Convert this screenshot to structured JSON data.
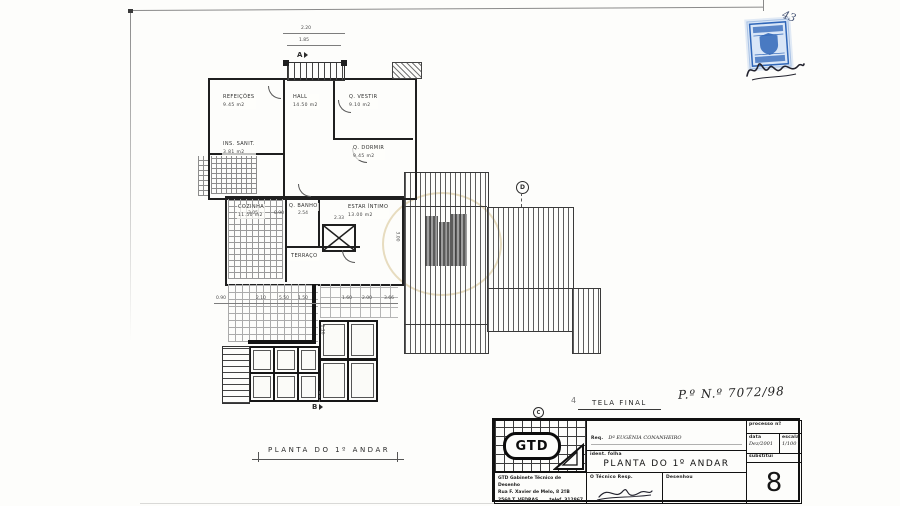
{
  "document": {
    "type": "scanned architectural drawing",
    "tela_final": "TELA FINAL",
    "process_number": "P.º N.º 7072/98",
    "fold_mark": "4",
    "caption": "PLANTA  DO  1º ANDAR",
    "stamp_note": "43"
  },
  "markers": {
    "a": "A",
    "b": "B",
    "c": "C",
    "d": "D"
  },
  "plan": {
    "rooms": [
      {
        "name": "REFEIÇÕES",
        "area": "9.45 m2"
      },
      {
        "name": "HALL",
        "area": "14.50 m2"
      },
      {
        "name": "Q. VESTIR",
        "area": "9.10 m2"
      },
      {
        "name": "Q. DORMIR",
        "area": "9.45 m2"
      },
      {
        "name": "INS. SANIT.",
        "area": "3.81 m2"
      },
      {
        "name": "COZINHA",
        "area": "11.50 m2"
      },
      {
        "name": "Q. BANHO",
        "area": ""
      },
      {
        "name": "ESTAR ÍNTIMO",
        "area": "13.00 m2"
      },
      {
        "name": "TERRAÇO",
        "area": ""
      }
    ],
    "dimensions": [
      "2.20",
      "1.85",
      "3.05",
      "0.90",
      "2.54",
      "2.33",
      "3.00",
      "0.90",
      "2.10",
      "5.50",
      "1.50",
      "1.60",
      "2.00",
      "3.66",
      "1.16"
    ]
  },
  "title_block": {
    "logo_text": "GTD",
    "req_label": "Req.",
    "req_value": "Dª EUGÉNIA CONANHEIRO",
    "local_label": "Local.",
    "local_value": "VILA FACAIA — RAMALHAL",
    "assunto_label": "Assunto.",
    "assunto_value": "LEGALIZAÇÃO DE ALTERAÇÕES",
    "ident_label": "ident. folha",
    "drawing_title": "PLANTA   DO   1º ANDAR",
    "processo_label": "processo nº",
    "data_label": "data",
    "data_value": "Dez/2001",
    "escala_label": "escala",
    "escala_value": "1/100",
    "substitui_label": "substitui",
    "tecnico_label": "O Técnico Resp.",
    "desenhou_label": "Desenhou",
    "sheet_number": "8",
    "company_line1": "GTD  Gabinete Técnico de Desenho",
    "company_line2": "Rua F. Xavier de Melo, 8  2ºB",
    "company_line3": "2560  T. VEDRAS",
    "company_phone": "telef. 312867"
  }
}
